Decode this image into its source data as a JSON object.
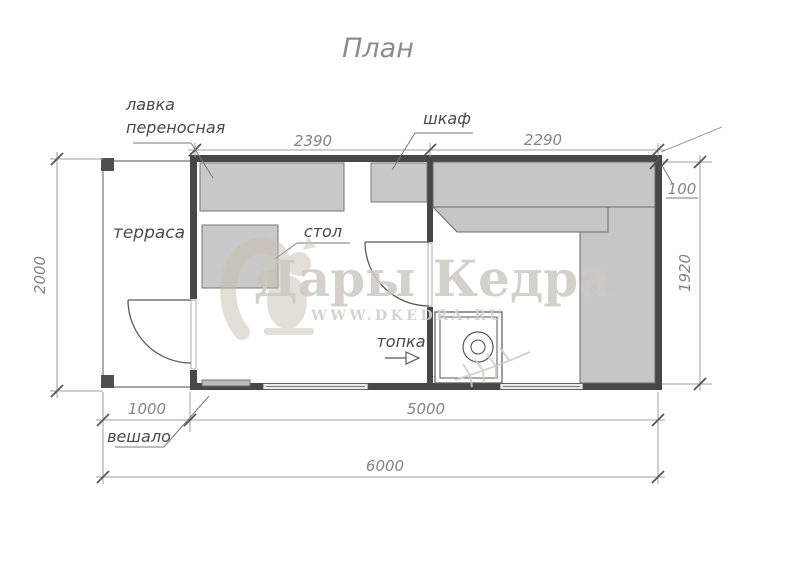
{
  "title": "План",
  "watermark": {
    "brand": "Дары Кедра",
    "site": "WWW.DKEDRA.RU",
    "logo": "squirrel-logo"
  },
  "labels": {
    "terrace": "терраса",
    "bench_line1": "лавка",
    "bench_line2": "переносная",
    "table": "стол",
    "cabinet": "шкаф",
    "furnace": "топка",
    "hanger": "вешало"
  },
  "dims": {
    "room1_width": "2390",
    "room2_width": "2290",
    "wall_thickness": "100",
    "terrace_depth": "2000",
    "inner_depth": "1920",
    "terrace_width": "1000",
    "house_width": "5000",
    "total_width": "6000"
  },
  "colors": {
    "wall": "#474747",
    "bench_fill": "#c6c6c6",
    "furniture_fill": "#c9c9c9",
    "dim_line": "#9f9f9f",
    "label_text": "#4a4a4a",
    "dim_text": "#848484",
    "watermark": "#cdcac3"
  }
}
